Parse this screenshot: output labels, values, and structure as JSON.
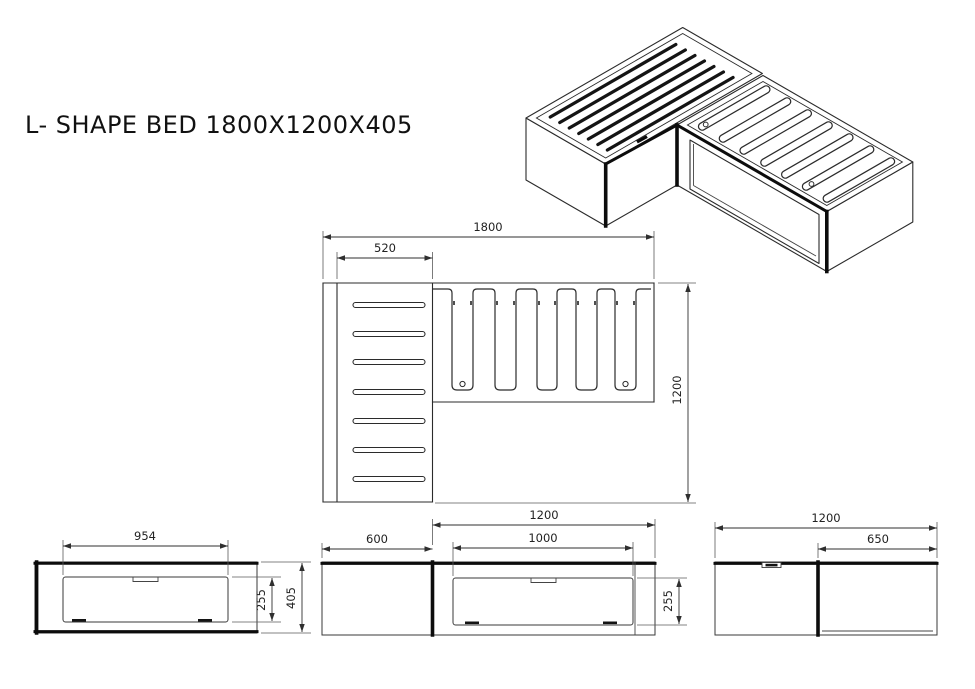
{
  "title": "L- SHAPE BED 1800X1200X405",
  "colors": {
    "line": "#2b2b2b",
    "thick_line": "#0c0c0c",
    "background": "#ffffff"
  },
  "plan": {
    "width": "1800",
    "left_width": "520",
    "depth": "1200"
  },
  "elevation_left": {
    "drawer_width": "954",
    "drawer_height": "255",
    "height": "405"
  },
  "elevation_middle": {
    "left_width": "600",
    "right_width": "1200",
    "drawer_width": "1000",
    "drawer_height": "255"
  },
  "elevation_right": {
    "width": "1200",
    "right_width": "650"
  }
}
